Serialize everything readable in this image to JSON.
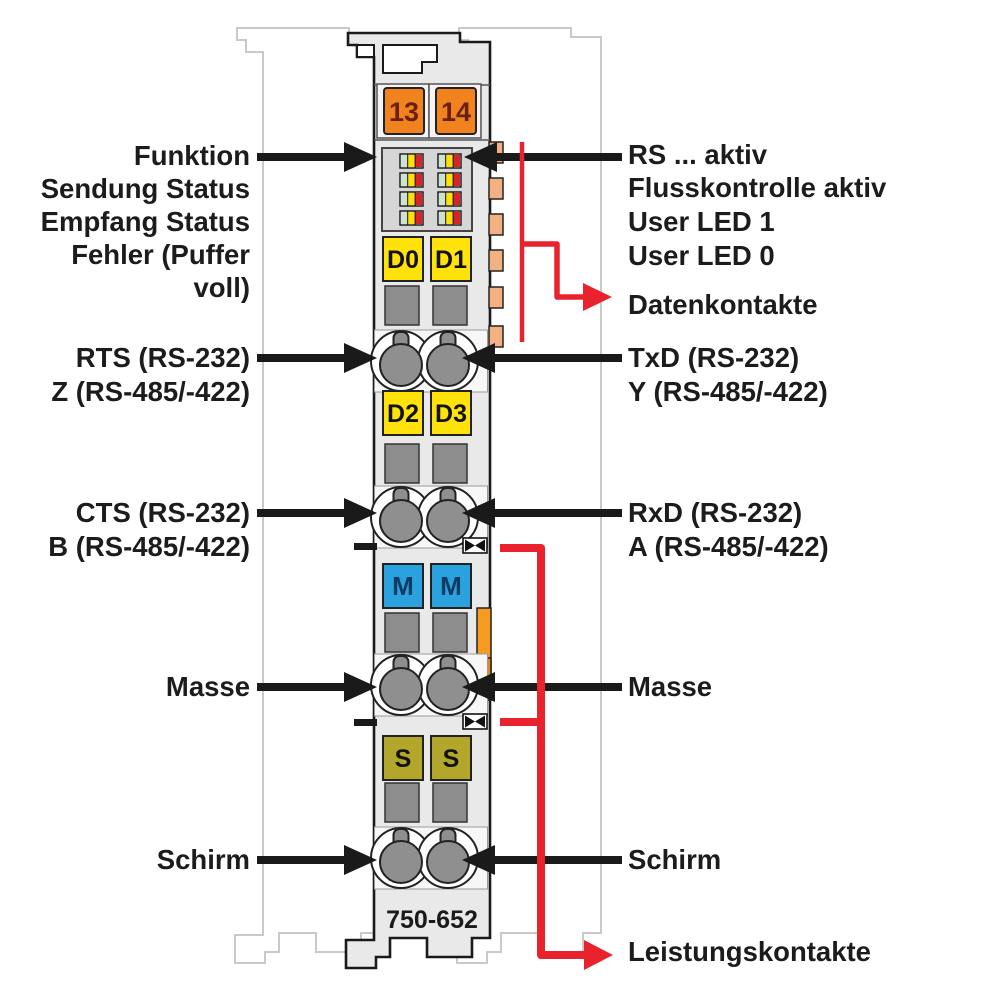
{
  "module": {
    "part_number": "750-652",
    "terminals": {
      "top": [
        "13",
        "14"
      ],
      "data_upper": [
        "D0",
        "D1"
      ],
      "data_lower": [
        "D2",
        "D3"
      ],
      "ground": [
        "M",
        "M"
      ],
      "shield": [
        "S",
        "S"
      ]
    },
    "led_matrix": {
      "columns": 2,
      "rows": 4,
      "segments_per_led": [
        "green",
        "yellow",
        "red"
      ]
    }
  },
  "annotations": {
    "left": [
      {
        "lines": [
          "Funktion",
          "Sendung Status",
          "Empfang Status",
          "Fehler (Puffer",
          "voll)"
        ]
      },
      {
        "lines": [
          "RTS (RS-232)",
          "Z (RS-485/-422)"
        ]
      },
      {
        "lines": [
          "CTS (RS-232)",
          "B (RS-485/-422)"
        ]
      },
      {
        "lines": [
          "Masse"
        ]
      },
      {
        "lines": [
          "Schirm"
        ]
      }
    ],
    "right": [
      {
        "lines": [
          "RS ... aktiv",
          "Flusskontrolle aktiv",
          "User LED 1",
          "User LED 0"
        ]
      },
      {
        "lines": [
          "Datenkontakte"
        ]
      },
      {
        "lines": [
          "TxD (RS-232)",
          "Y (RS-485/-422)"
        ]
      },
      {
        "lines": [
          "RxD (RS-232)",
          "A (RS-485/-422)"
        ]
      },
      {
        "lines": [
          "Masse"
        ]
      },
      {
        "lines": [
          "Schirm"
        ]
      },
      {
        "lines": [
          "Leistungskontakte"
        ]
      }
    ]
  },
  "colors": {
    "module_fill": "#e9e9e9",
    "module_outline": "#1a1a1a",
    "silhouette_gray": "#c9c9c9",
    "terminal_orange": "#f0831e",
    "terminal_yellow": "#ffe20a",
    "terminal_blue": "#2aa2dd",
    "terminal_olive": "#b2a62b",
    "data_contact_peach": "#f3b083",
    "latch_orange": "#f59b20",
    "annotation_red": "#e8232e",
    "annotation_black": "#1a1a1a",
    "led_green": "#cde3d2",
    "led_yellow": "#ffe10a",
    "led_red": "#d8232a",
    "clamp_gray": "#8f8f8f"
  }
}
